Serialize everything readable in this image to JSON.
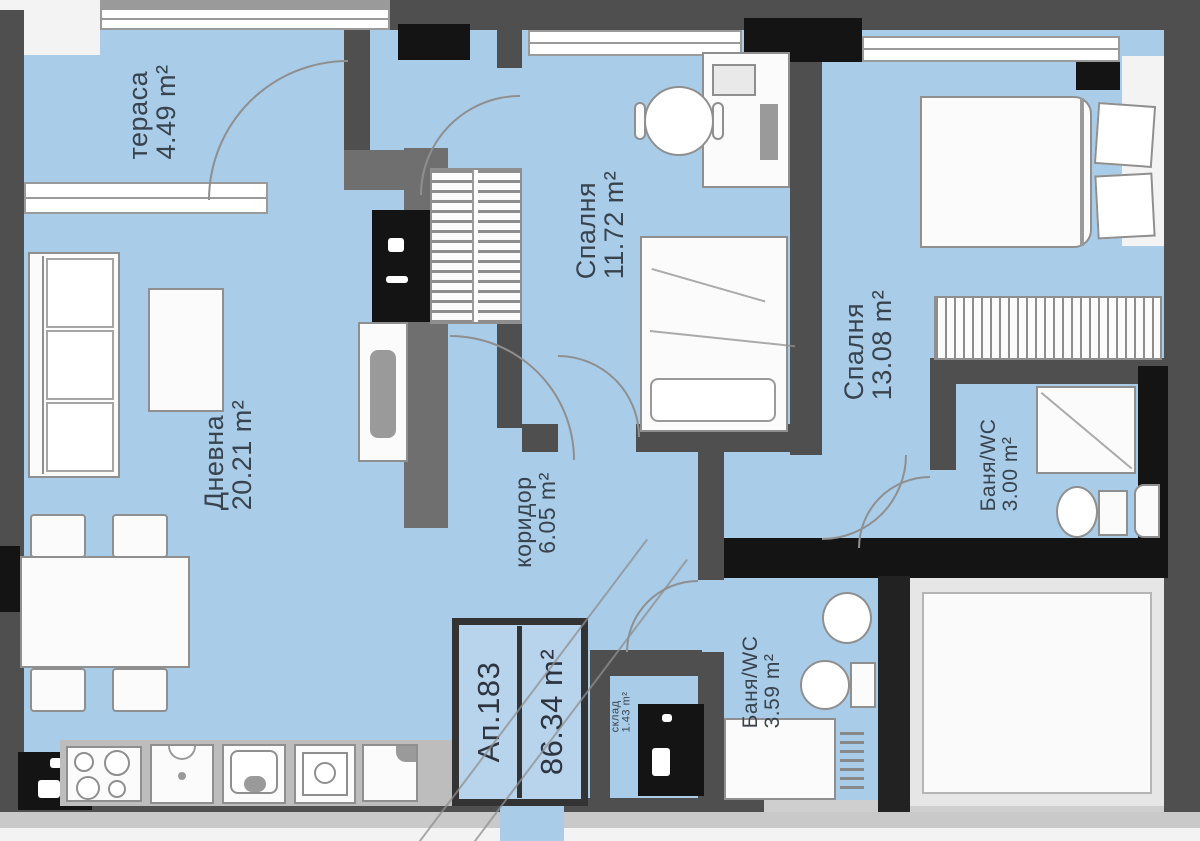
{
  "plan": {
    "type": "apartment-floor-plan",
    "unit": "m²",
    "apartment": {
      "id": "Ап.183",
      "total_area": "86.34 m²"
    },
    "rooms": {
      "terrace": {
        "name": "тераса",
        "area": "4.49 m²"
      },
      "living": {
        "name": "Дневна",
        "area": "20.21 m²"
      },
      "bedroom1": {
        "name": "Спалня",
        "area": "11.72 m²"
      },
      "bedroom2": {
        "name": "Спалня",
        "area": "13.08 m²"
      },
      "corridor": {
        "name": "коридор",
        "area": "6.05 m²"
      },
      "bath1": {
        "name": "Баня/WC",
        "area": "3.00 m²"
      },
      "bath2": {
        "name": "Баня/WC",
        "area": "3.59 m²"
      },
      "storage": {
        "name": "склад",
        "area": "1.43 m²"
      }
    },
    "colors": {
      "floor": "#a9cce8",
      "wall": "#4f4f4f",
      "accent_black": "#141414",
      "furniture_fill": "#fbfbfb",
      "furniture_stroke": "#8f8f8f",
      "label_text": "#39434e"
    }
  }
}
